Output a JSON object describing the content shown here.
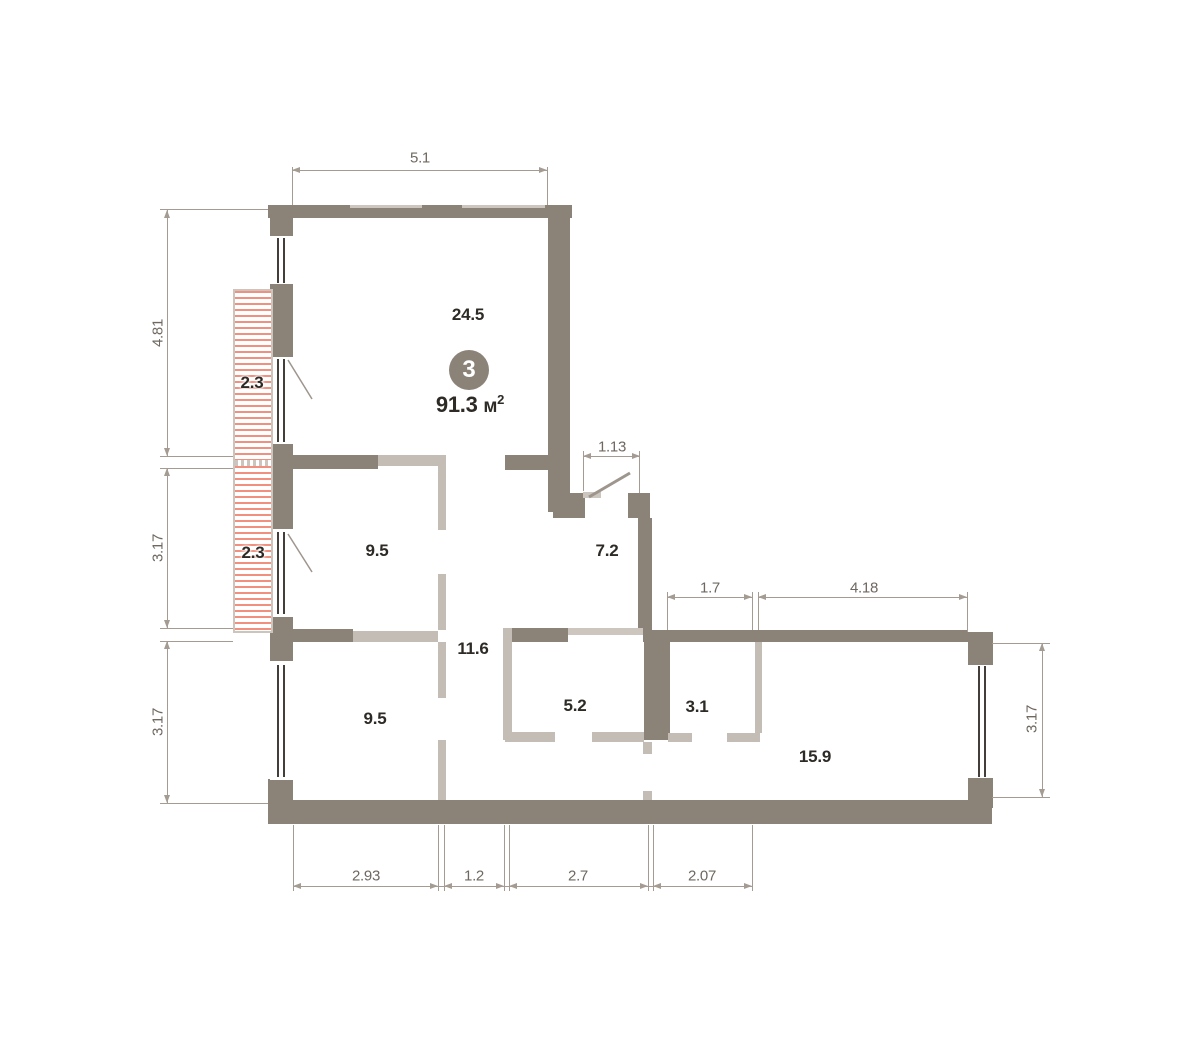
{
  "badge": {
    "number": "3",
    "area": "91.3",
    "area_unit": "м",
    "area_sup": "2"
  },
  "rooms": {
    "living": {
      "area": "24.5"
    },
    "bedroom_middle": {
      "area": "9.5"
    },
    "hallway": {
      "area": "7.2"
    },
    "corridor": {
      "area": "11.6"
    },
    "bedroom_bottom": {
      "area": "9.5"
    },
    "kitchen_niche": {
      "area": "5.2"
    },
    "bathroom": {
      "area": "3.1"
    },
    "kitchen_living": {
      "area": "15.9"
    },
    "balcony_top": {
      "area": "2.3"
    },
    "balcony_bottom": {
      "area": "2.3"
    }
  },
  "dimensions": {
    "top_width": "5.1",
    "entry_opening": "1.13",
    "inner_left": "1.7",
    "inner_right": "4.18",
    "left_upper": "4.81",
    "left_middle": "3.17",
    "left_lower": "3.17",
    "right_side": "3.17",
    "bottom_1": "2.93",
    "bottom_2": "1.2",
    "bottom_3": "2.7",
    "bottom_4": "2.07"
  },
  "colors": {
    "wall": "#8b8278",
    "part": "#c3bdb5",
    "lintel": "#ccc6bf",
    "hatch": "#f2907f",
    "dim": "#a49c93",
    "dimtext": "#6f6860",
    "ink": "#2e2a26",
    "glass": "#433e39",
    "swing": "#9e968d",
    "balcborder": "#cbc5be"
  }
}
